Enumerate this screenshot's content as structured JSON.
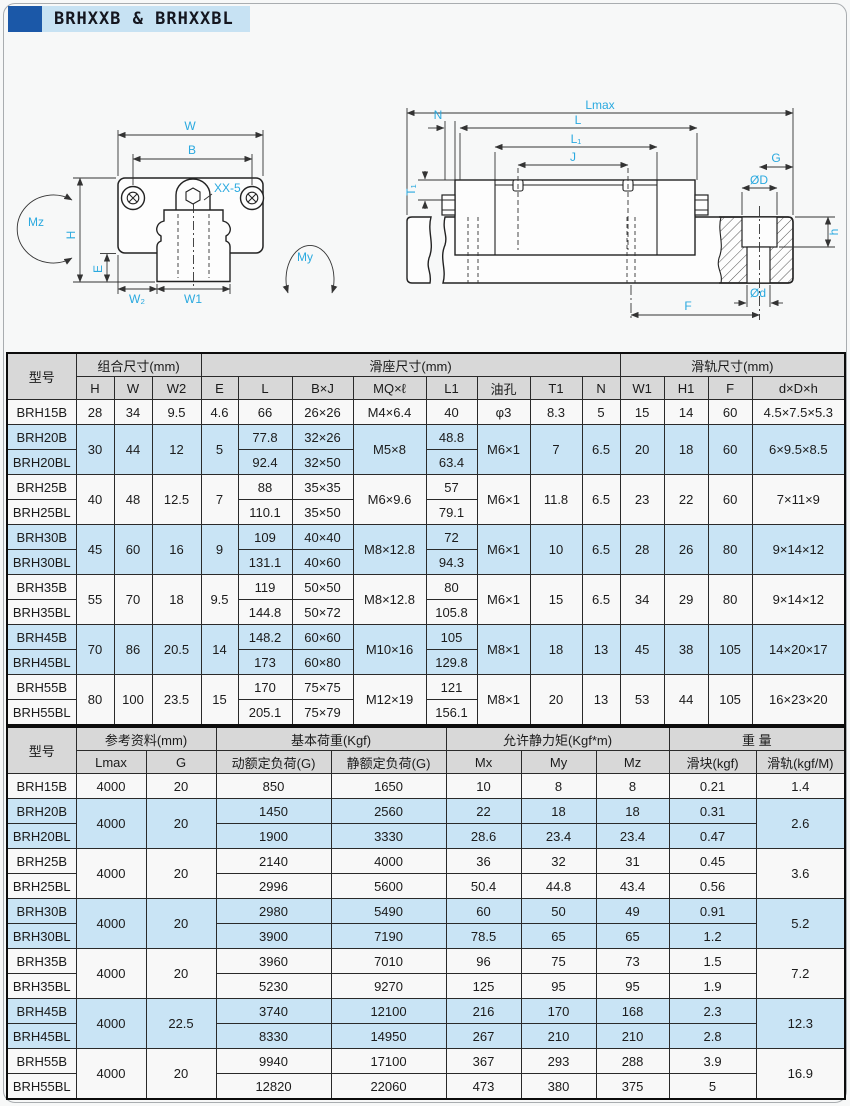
{
  "header": {
    "title": "BRHXXB & BRHXXBL"
  },
  "colors": {
    "title_square": "#1b58a8",
    "title_bar_bg": "#c7e2f3",
    "row_blue": "#c9e4f5",
    "row_white": "#f8f8f8",
    "header_gray": "#d8d8d8",
    "dim_label_cyan": "#2aa9df"
  },
  "diagram_left": {
    "labels": {
      "w": "W",
      "b": "B",
      "xx5": "XX-5",
      "mz": "Mz",
      "my": "My",
      "h": "H",
      "e": "E",
      "w2": "W₂",
      "w1": "W1"
    }
  },
  "diagram_right": {
    "labels": {
      "lmax": "Lmax",
      "n": "N",
      "l": "L",
      "l1": "L₁",
      "j": "J",
      "t1": "T₁",
      "g": "G",
      "od_big": "ØD",
      "h": "h",
      "f": "F",
      "od_small": "Ød"
    }
  },
  "table1": {
    "groups": [
      [
        "型号",
        1,
        2
      ],
      [
        "组合尺寸(mm)",
        3,
        1
      ],
      [
        "滑座尺寸(mm)",
        8,
        1
      ],
      [
        "滑轨尺寸(mm)",
        4,
        1
      ]
    ],
    "cols": [
      "H",
      "W",
      "W2",
      "E",
      "L",
      "B×J",
      "MQ×ℓ",
      "L1",
      "油孔",
      "T1",
      "N",
      "W1",
      "H1",
      "F",
      "d×D×h"
    ],
    "rows": [
      {
        "shade": "w",
        "cells": [
          "BRH15B",
          "28",
          "34",
          "9.5",
          "4.6",
          "66",
          "26×26",
          "M4×6.4",
          "40",
          "φ3",
          "8.3",
          "5",
          "15",
          "14",
          "60",
          "4.5×7.5×5.3"
        ]
      },
      {
        "shade": "b",
        "cells": [
          "BRH20B",
          [
            "30",
            2
          ],
          [
            "44",
            2
          ],
          [
            "12",
            2
          ],
          [
            "5",
            2
          ],
          "77.8",
          "32×26",
          [
            "M5×8",
            2
          ],
          "48.8",
          [
            "M6×1",
            2
          ],
          [
            "7",
            2
          ],
          [
            "6.5",
            2
          ],
          [
            "20",
            2
          ],
          [
            "18",
            2
          ],
          [
            "60",
            2
          ],
          [
            "6×9.5×8.5",
            2
          ]
        ]
      },
      {
        "shade": "b",
        "cells": [
          "BRH20BL",
          "92.4",
          "32×50",
          "63.4"
        ]
      },
      {
        "shade": "w",
        "cells": [
          "BRH25B",
          [
            "40",
            2
          ],
          [
            "48",
            2
          ],
          [
            "12.5",
            2
          ],
          [
            "7",
            2
          ],
          "88",
          "35×35",
          [
            "M6×9.6",
            2
          ],
          "57",
          [
            "M6×1",
            2
          ],
          [
            "11.8",
            2
          ],
          [
            "6.5",
            2
          ],
          [
            "23",
            2
          ],
          [
            "22",
            2
          ],
          [
            "60",
            2
          ],
          [
            "7×11×9",
            2
          ]
        ]
      },
      {
        "shade": "w",
        "cells": [
          "BRH25BL",
          "110.1",
          "35×50",
          "79.1"
        ]
      },
      {
        "shade": "b",
        "cells": [
          "BRH30B",
          [
            "45",
            2
          ],
          [
            "60",
            2
          ],
          [
            "16",
            2
          ],
          [
            "9",
            2
          ],
          "109",
          "40×40",
          [
            "M8×12.8",
            2
          ],
          "72",
          [
            "M6×1",
            2
          ],
          [
            "10",
            2
          ],
          [
            "6.5",
            2
          ],
          [
            "28",
            2
          ],
          [
            "26",
            2
          ],
          [
            "80",
            2
          ],
          [
            "9×14×12",
            2
          ]
        ]
      },
      {
        "shade": "b",
        "cells": [
          "BRH30BL",
          "131.1",
          "40×60",
          "94.3"
        ]
      },
      {
        "shade": "w",
        "cells": [
          "BRH35B",
          [
            "55",
            2
          ],
          [
            "70",
            2
          ],
          [
            "18",
            2
          ],
          [
            "9.5",
            2
          ],
          "119",
          "50×50",
          [
            "M8×12.8",
            2
          ],
          "80",
          [
            "M6×1",
            2
          ],
          [
            "15",
            2
          ],
          [
            "6.5",
            2
          ],
          [
            "34",
            2
          ],
          [
            "29",
            2
          ],
          [
            "80",
            2
          ],
          [
            "9×14×12",
            2
          ]
        ]
      },
      {
        "shade": "w",
        "cells": [
          "BRH35BL",
          "144.8",
          "50×72",
          "105.8"
        ]
      },
      {
        "shade": "b",
        "cells": [
          "BRH45B",
          [
            "70",
            2
          ],
          [
            "86",
            2
          ],
          [
            "20.5",
            2
          ],
          [
            "14",
            2
          ],
          "148.2",
          "60×60",
          [
            "M10×16",
            2
          ],
          "105",
          [
            "M8×1",
            2
          ],
          [
            "18",
            2
          ],
          [
            "13",
            2
          ],
          [
            "45",
            2
          ],
          [
            "38",
            2
          ],
          [
            "105",
            2
          ],
          [
            "14×20×17",
            2
          ]
        ]
      },
      {
        "shade": "b",
        "cells": [
          "BRH45BL",
          "173",
          "60×80",
          "129.8"
        ]
      },
      {
        "shade": "w",
        "cells": [
          "BRH55B",
          [
            "80",
            2
          ],
          [
            "100",
            2
          ],
          [
            "23.5",
            2
          ],
          [
            "15",
            2
          ],
          "170",
          "75×75",
          [
            "M12×19",
            2
          ],
          "121",
          [
            "M8×1",
            2
          ],
          [
            "20",
            2
          ],
          [
            "13",
            2
          ],
          [
            "53",
            2
          ],
          [
            "44",
            2
          ],
          [
            "105",
            2
          ],
          [
            "16×23×20",
            2
          ]
        ]
      },
      {
        "shade": "w",
        "cells": [
          "BRH55BL",
          "205.1",
          "75×79",
          "156.1"
        ]
      }
    ]
  },
  "table2": {
    "groups": [
      [
        "型号",
        1,
        2
      ],
      [
        "参考资料(mm)",
        2,
        1
      ],
      [
        "基本荷重(Kgf)",
        2,
        1
      ],
      [
        "允许静力矩(Kgf*m)",
        3,
        1
      ],
      [
        "重 量",
        2,
        1
      ]
    ],
    "cols": [
      "Lmax",
      "G",
      "动额定负荷(G)",
      "静额定负荷(G)",
      "Mx",
      "My",
      "Mz",
      "滑块(kgf)",
      "滑轨(kgf/M)"
    ],
    "rows": [
      {
        "shade": "w",
        "cells": [
          "BRH15B",
          "4000",
          "20",
          "850",
          "1650",
          "10",
          "8",
          "8",
          "0.21",
          "1.4"
        ]
      },
      {
        "shade": "b",
        "cells": [
          "BRH20B",
          [
            "4000",
            2
          ],
          [
            "20",
            2
          ],
          "1450",
          "2560",
          "22",
          "18",
          "18",
          "0.31",
          [
            "2.6",
            2
          ]
        ]
      },
      {
        "shade": "b",
        "cells": [
          "BRH20BL",
          "1900",
          "3330",
          "28.6",
          "23.4",
          "23.4",
          "0.47"
        ]
      },
      {
        "shade": "w",
        "cells": [
          "BRH25B",
          [
            "4000",
            2
          ],
          [
            "20",
            2
          ],
          "2140",
          "4000",
          "36",
          "32",
          "31",
          "0.45",
          [
            "3.6",
            2
          ]
        ]
      },
      {
        "shade": "w",
        "cells": [
          "BRH25BL",
          "2996",
          "5600",
          "50.4",
          "44.8",
          "43.4",
          "0.56"
        ]
      },
      {
        "shade": "b",
        "cells": [
          "BRH30B",
          [
            "4000",
            2
          ],
          [
            "20",
            2
          ],
          "2980",
          "5490",
          "60",
          "50",
          "49",
          "0.91",
          [
            "5.2",
            2
          ]
        ]
      },
      {
        "shade": "b",
        "cells": [
          "BRH30BL",
          "3900",
          "7190",
          "78.5",
          "65",
          "65",
          "1.2"
        ]
      },
      {
        "shade": "w",
        "cells": [
          "BRH35B",
          [
            "4000",
            2
          ],
          [
            "20",
            2
          ],
          "3960",
          "7010",
          "96",
          "75",
          "73",
          "1.5",
          [
            "7.2",
            2
          ]
        ]
      },
      {
        "shade": "w",
        "cells": [
          "BRH35BL",
          "5230",
          "9270",
          "125",
          "95",
          "95",
          "1.9"
        ]
      },
      {
        "shade": "b",
        "cells": [
          "BRH45B",
          [
            "4000",
            2
          ],
          [
            "22.5",
            2
          ],
          "3740",
          "12100",
          "216",
          "170",
          "168",
          "2.3",
          [
            "12.3",
            2
          ]
        ]
      },
      {
        "shade": "b",
        "cells": [
          "BRH45BL",
          "8330",
          "14950",
          "267",
          "210",
          "210",
          "2.8"
        ]
      },
      {
        "shade": "w",
        "cells": [
          "BRH55B",
          [
            "4000",
            2
          ],
          [
            "20",
            2
          ],
          "9940",
          "17100",
          "367",
          "293",
          "288",
          "3.9",
          [
            "16.9",
            2
          ]
        ]
      },
      {
        "shade": "w",
        "cells": [
          "BRH55BL",
          "12820",
          "22060",
          "473",
          "380",
          "375",
          "5"
        ]
      }
    ]
  }
}
